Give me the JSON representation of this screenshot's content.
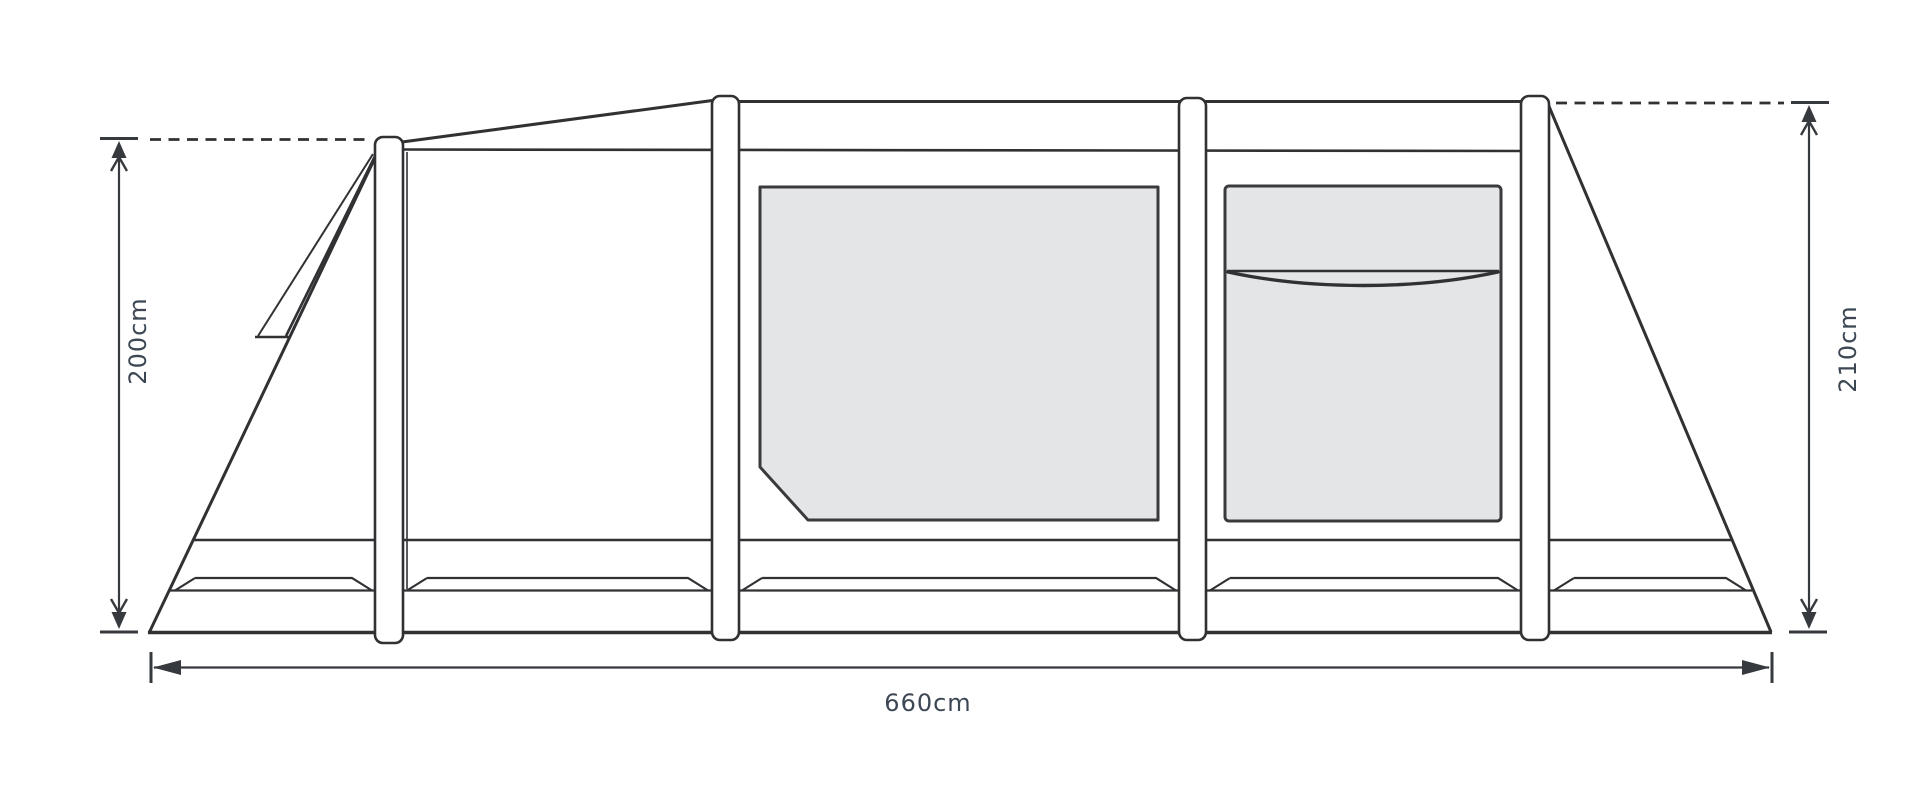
{
  "diagram": {
    "subject": "tent-side-elevation",
    "labels": {
      "left_height": "200cm",
      "right_height": "210cm",
      "total_length": "660cm"
    },
    "colors": {
      "background": "#ffffff",
      "outline": "#313134",
      "panel_fill": "#e4e5e7",
      "dimension_text": "#3d4754"
    }
  }
}
